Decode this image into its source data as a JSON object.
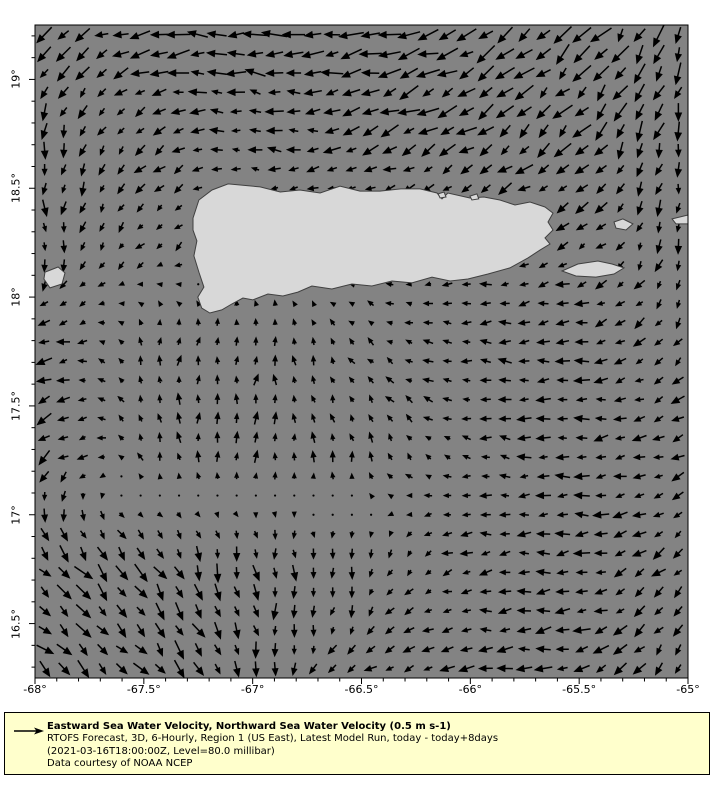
{
  "colors": {
    "background": "#ffffff",
    "sea": "#838383",
    "land": "#d8d8d8",
    "coast": "#404040",
    "arrow": "#000000",
    "frame": "#000000",
    "legend_bg": "#ffffcc",
    "text": "#000000"
  },
  "axes": {
    "lon_min": -68.0,
    "lon_max": -65.0,
    "lat_min": 16.25,
    "lat_max": 19.25,
    "minor_tick_step": 0.1,
    "xticks": [
      {
        "lon": -68.0,
        "label": "-68°"
      },
      {
        "lon": -67.5,
        "label": "-67.5°"
      },
      {
        "lon": -67.0,
        "label": "-67°"
      },
      {
        "lon": -66.5,
        "label": "-66.5°"
      },
      {
        "lon": -66.0,
        "label": "-66°"
      },
      {
        "lon": -65.5,
        "label": "-65.5°"
      },
      {
        "lon": -65.0,
        "label": "-65°"
      }
    ],
    "yticks": [
      {
        "lat": 19.0,
        "label": "19°"
      },
      {
        "lat": 18.5,
        "label": "18.5°"
      },
      {
        "lat": 18.0,
        "label": "18°"
      },
      {
        "lat": 17.5,
        "label": "17.5°"
      },
      {
        "lat": 17.0,
        "label": "17°"
      },
      {
        "lat": 16.5,
        "label": "16.5°"
      }
    ]
  },
  "legend": {
    "title": "Eastward Sea Water Velocity, Northward Sea Water Velocity (0.5 m s-1)",
    "line2": "RTOFS Forecast, 3D, 6-Hourly, Region 1 (US East), Latest Model Run, today - today+8days",
    "line3": "(2021-03-16T18:00:00Z, Level=80.0 millibar)",
    "line4": "Data courtesy of NOAA NCEP"
  },
  "map": {
    "land": {
      "puerto_rico": [
        [
          -67.274,
          18.363
        ],
        [
          -67.247,
          18.446
        ],
        [
          -67.187,
          18.492
        ],
        [
          -67.113,
          18.52
        ],
        [
          -66.966,
          18.506
        ],
        [
          -66.873,
          18.483
        ],
        [
          -66.783,
          18.492
        ],
        [
          -66.69,
          18.478
        ],
        [
          -66.599,
          18.51
        ],
        [
          -66.507,
          18.487
        ],
        [
          -66.415,
          18.487
        ],
        [
          -66.319,
          18.497
        ],
        [
          -66.231,
          18.497
        ],
        [
          -66.153,
          18.478
        ],
        [
          -66.13,
          18.451
        ],
        [
          -66.103,
          18.478
        ],
        [
          -66.002,
          18.455
        ],
        [
          -65.938,
          18.46
        ],
        [
          -65.864,
          18.446
        ],
        [
          -65.795,
          18.423
        ],
        [
          -65.726,
          18.437
        ],
        [
          -65.657,
          18.414
        ],
        [
          -65.62,
          18.386
        ],
        [
          -65.643,
          18.345
        ],
        [
          -65.62,
          18.308
        ],
        [
          -65.657,
          18.272
        ],
        [
          -65.634,
          18.244
        ],
        [
          -65.68,
          18.216
        ],
        [
          -65.735,
          18.18
        ],
        [
          -65.818,
          18.134
        ],
        [
          -65.919,
          18.106
        ],
        [
          -66.011,
          18.083
        ],
        [
          -66.093,
          18.074
        ],
        [
          -66.176,
          18.092
        ],
        [
          -66.268,
          18.065
        ],
        [
          -66.36,
          18.074
        ],
        [
          -66.452,
          18.051
        ],
        [
          -66.544,
          18.06
        ],
        [
          -66.636,
          18.037
        ],
        [
          -66.728,
          18.051
        ],
        [
          -66.792,
          18.023
        ],
        [
          -66.861,
          18.005
        ],
        [
          -66.93,
          18.014
        ],
        [
          -66.999,
          17.987
        ],
        [
          -67.045,
          17.996
        ],
        [
          -67.096,
          17.968
        ],
        [
          -67.142,
          17.941
        ],
        [
          -67.197,
          17.927
        ],
        [
          -67.234,
          17.95
        ],
        [
          -67.252,
          18.0
        ],
        [
          -67.224,
          18.046
        ],
        [
          -67.247,
          18.115
        ],
        [
          -67.27,
          18.189
        ],
        [
          -67.256,
          18.258
        ],
        [
          -67.274,
          18.308
        ]
      ],
      "mona": [
        [
          -67.954,
          18.115
        ],
        [
          -67.894,
          18.138
        ],
        [
          -67.862,
          18.111
        ],
        [
          -67.876,
          18.06
        ],
        [
          -67.931,
          18.042
        ],
        [
          -67.959,
          18.083
        ]
      ],
      "vieques": [
        [
          -65.579,
          18.12
        ],
        [
          -65.506,
          18.152
        ],
        [
          -65.414,
          18.166
        ],
        [
          -65.349,
          18.152
        ],
        [
          -65.294,
          18.134
        ],
        [
          -65.34,
          18.106
        ],
        [
          -65.423,
          18.092
        ],
        [
          -65.515,
          18.097
        ]
      ],
      "culebra": [
        [
          -65.34,
          18.345
        ],
        [
          -65.299,
          18.359
        ],
        [
          -65.253,
          18.336
        ],
        [
          -65.285,
          18.308
        ],
        [
          -65.331,
          18.317
        ]
      ],
      "st_thomas": [
        [
          -65.073,
          18.359
        ],
        [
          -65.0,
          18.377
        ],
        [
          -65.0,
          18.336
        ],
        [
          -65.055,
          18.336
        ]
      ],
      "islet_san_juan": [
        [
          -66.148,
          18.474
        ],
        [
          -66.121,
          18.483
        ],
        [
          -66.112,
          18.46
        ],
        [
          -66.139,
          18.455
        ]
      ],
      "islet_north_east": [
        [
          -66.002,
          18.464
        ],
        [
          -65.97,
          18.474
        ],
        [
          -65.961,
          18.451
        ],
        [
          -65.993,
          18.446
        ]
      ]
    }
  },
  "chart_data": {
    "type": "quiver",
    "title": "Eastward Sea Water Velocity, Northward Sea Water Velocity",
    "units": "m s-1",
    "reference_value": 0.5,
    "reference_label": "0.5 m s-1",
    "lon_range": [
      -68.0,
      -65.0
    ],
    "lat_range": [
      16.25,
      19.25
    ],
    "grid": {
      "nx": 34,
      "ny": 34
    },
    "flow_control_grid": {
      "description": "coarse 7x7 estimate of (u,v) ocean current components (u=east,v=north, m/s); row 0 = northern edge, column 0 = western edge; bilinearly interpolated to the full arrow grid",
      "u": [
        [
          -0.45,
          -0.75,
          -0.7,
          -0.75,
          -0.65,
          -0.5,
          -0.3
        ],
        [
          -0.05,
          -0.3,
          -0.4,
          -0.55,
          -0.5,
          -0.45,
          -0.1
        ],
        [
          0.0,
          -0.25,
          -0.1,
          -0.1,
          -0.3,
          -0.35,
          -0.05
        ],
        [
          -0.5,
          0.05,
          0.05,
          -0.2,
          -0.35,
          -0.45,
          -0.3
        ],
        [
          -0.4,
          -0.1,
          0.0,
          -0.05,
          -0.3,
          -0.45,
          -0.4
        ],
        [
          0.4,
          0.35,
          0.05,
          0.0,
          -0.35,
          -0.45,
          -0.35
        ],
        [
          0.45,
          0.4,
          0.1,
          -0.3,
          -0.45,
          -0.5,
          -0.25
        ]
      ],
      "v": [
        [
          -0.45,
          -0.05,
          0.05,
          -0.1,
          -0.3,
          -0.5,
          -0.65
        ],
        [
          -0.55,
          -0.25,
          0.1,
          -0.2,
          -0.3,
          -0.45,
          -0.55
        ],
        [
          -0.4,
          -0.2,
          -0.1,
          -0.05,
          -0.1,
          -0.15,
          -0.45
        ],
        [
          -0.15,
          0.3,
          0.35,
          0.2,
          0.05,
          -0.05,
          -0.3
        ],
        [
          -0.3,
          0.3,
          0.35,
          0.3,
          0.05,
          0.0,
          -0.1
        ],
        [
          -0.45,
          -0.5,
          -0.5,
          -0.35,
          -0.05,
          -0.05,
          -0.3
        ],
        [
          -0.4,
          -0.45,
          -0.45,
          -0.2,
          -0.05,
          -0.1,
          -0.45
        ]
      ]
    }
  }
}
